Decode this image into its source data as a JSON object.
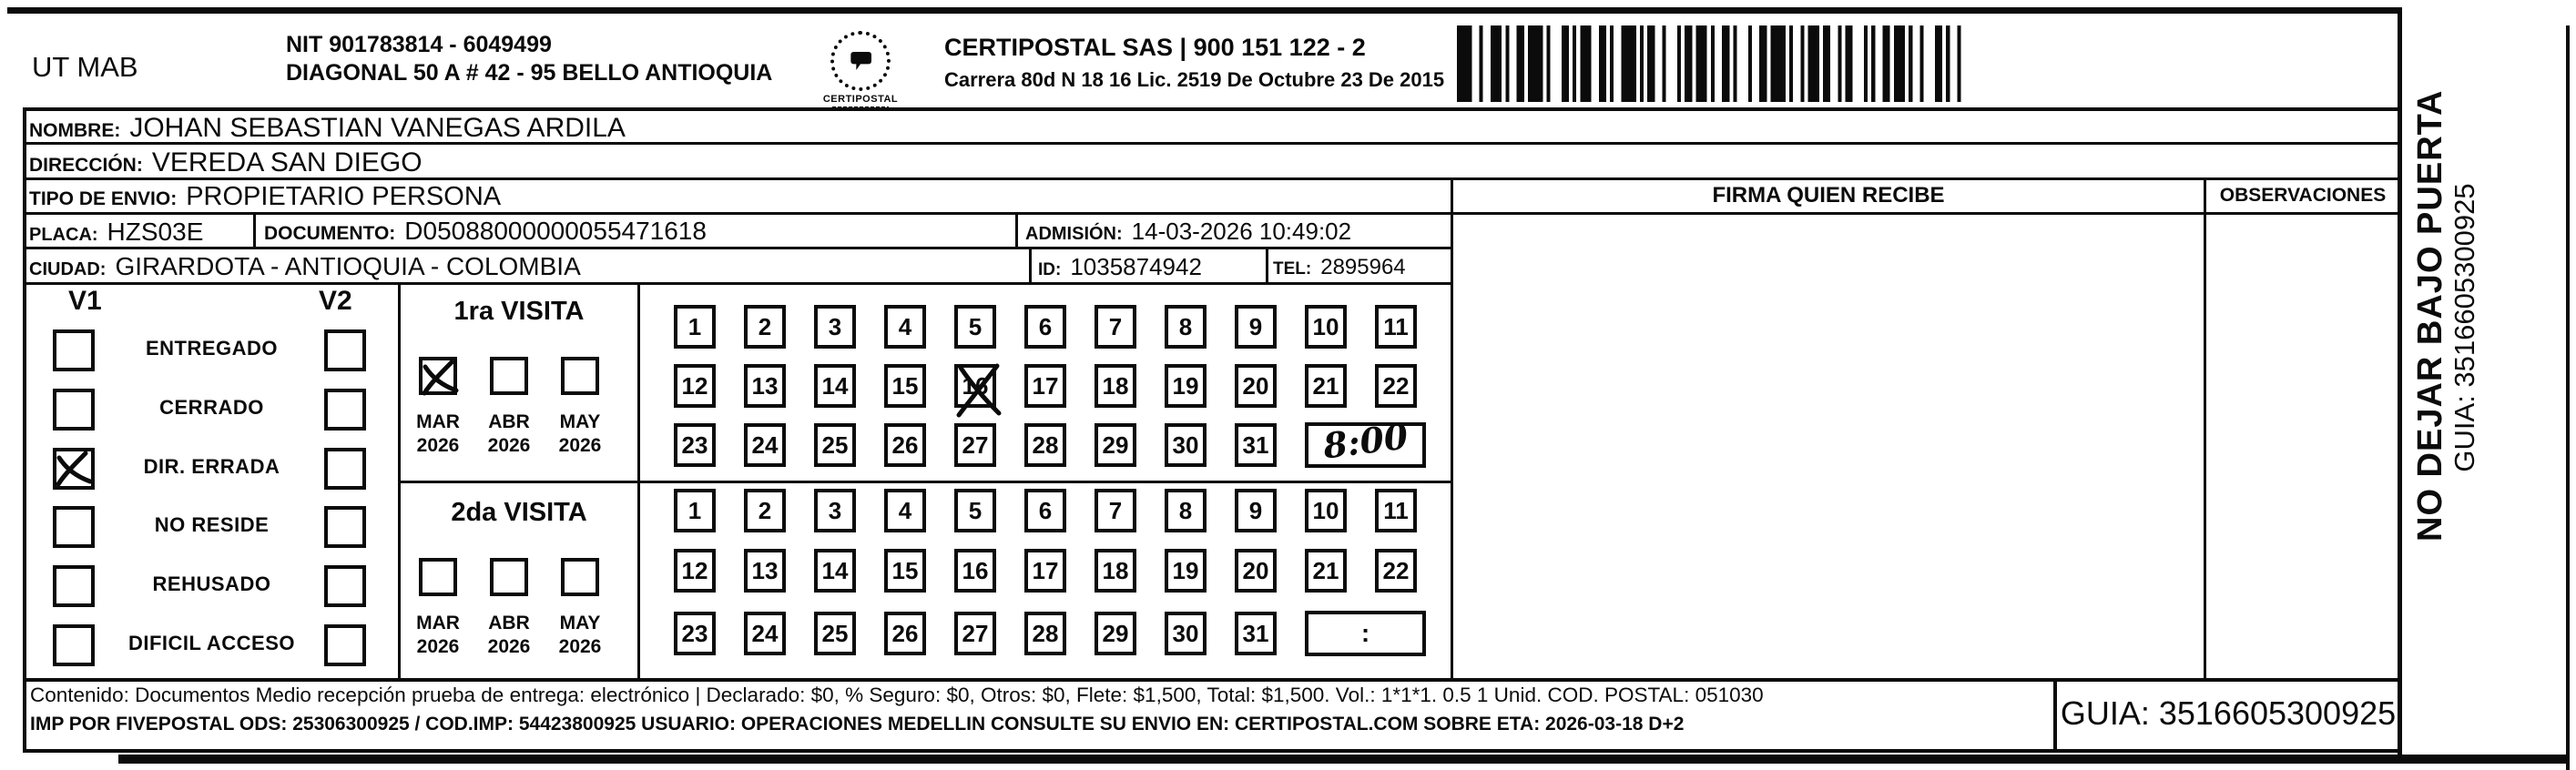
{
  "header": {
    "sender": "UT MAB",
    "nit": "NIT 901783814 - 6049499",
    "sender_address": "DIAGONAL 50 A # 42 - 95  BELLO  ANTIOQUIA",
    "logo_caption": "CERTIPOSTAL",
    "company": "CERTIPOSTAL SAS | 900 151 122 - 2",
    "license": "Carrera 80d N 18 16  Lic. 2519 De Octubre 23 De 2015"
  },
  "fields": {
    "nombre": {
      "label": "NOMBRE:",
      "value": "JOHAN SEBASTIAN VANEGAS ARDILA"
    },
    "direccion": {
      "label": "DIRECCIÓN:",
      "value": "VEREDA SAN DIEGO"
    },
    "tipo_envio": {
      "label": "TIPO DE ENVIO:",
      "value": "PROPIETARIO PERSONA"
    },
    "placa": {
      "label": "PLACA:",
      "value": "HZS03E"
    },
    "documento": {
      "label": "DOCUMENTO:",
      "value": "D05088000000055471618"
    },
    "admision": {
      "label": "ADMISIÓN:",
      "value": "14-03-2026 10:49:02"
    },
    "ciudad": {
      "label": "CIUDAD:",
      "value": "GIRARDOTA - ANTIOQUIA - COLOMBIA"
    },
    "id": {
      "label": "ID:",
      "value": "1035874942"
    },
    "tel": {
      "label": "TEL:",
      "value": "2895964"
    }
  },
  "section_headers": {
    "firma": "FIRMA QUIEN RECIBE",
    "observaciones": "OBSERVACIONES"
  },
  "status_panel": {
    "col1": "V1",
    "col2": "V2",
    "options": [
      {
        "label": "ENTREGADO",
        "v1_checked": false,
        "v2_checked": false
      },
      {
        "label": "CERRADO",
        "v1_checked": false,
        "v2_checked": false
      },
      {
        "label": "DIR. ERRADA",
        "v1_checked": true,
        "v2_checked": false
      },
      {
        "label": "NO RESIDE",
        "v1_checked": false,
        "v2_checked": false
      },
      {
        "label": "REHUSADO",
        "v1_checked": false,
        "v2_checked": false
      },
      {
        "label": "DIFICIL ACCESO",
        "v1_checked": false,
        "v2_checked": false
      }
    ]
  },
  "visits": [
    {
      "title": "1ra VISITA",
      "months": [
        {
          "month": "MAR",
          "year": "2026",
          "checked": true
        },
        {
          "month": "ABR",
          "year": "2026",
          "checked": false
        },
        {
          "month": "MAY",
          "year": "2026",
          "checked": false
        }
      ],
      "crossed_day": 16,
      "time": "8:00"
    },
    {
      "title": "2da VISITA",
      "months": [
        {
          "month": "MAR",
          "year": "2026",
          "checked": false
        },
        {
          "month": "ABR",
          "year": "2026",
          "checked": false
        },
        {
          "month": "MAY",
          "year": "2026",
          "checked": false
        }
      ],
      "crossed_day": null,
      "time": ""
    }
  ],
  "day_numbers": [
    1,
    2,
    3,
    4,
    5,
    6,
    7,
    8,
    9,
    10,
    11,
    12,
    13,
    14,
    15,
    16,
    17,
    18,
    19,
    20,
    21,
    22,
    23,
    24,
    25,
    26,
    27,
    28,
    29,
    30,
    31
  ],
  "time_placeholder": ":",
  "footer": {
    "line1": "Contenido: Documentos Medio recepción prueba de entrega: electrónico | Declarado: $0, % Seguro: $0, Otros: $0, Flete: $1,500, Total: $1,500. Vol.: 1*1*1. 0.5  1 Unid. COD. POSTAL: 051030",
    "line2": "IMP POR FIVEPOSTAL ODS: 25306300925 / COD.IMP: 54423800925 USUARIO: OPERACIONES MEDELLIN CONSULTE SU ENVIO EN: CERTIPOSTAL.COM SOBRE ETA: 2026-03-18 D+2",
    "guia": "GUIA: 3516605300925"
  },
  "side_note": {
    "line1": "NO DEJAR BAJO PUERTA",
    "line2": "GUIA: 3516605300925"
  },
  "ink_color": "#0b0b0b"
}
